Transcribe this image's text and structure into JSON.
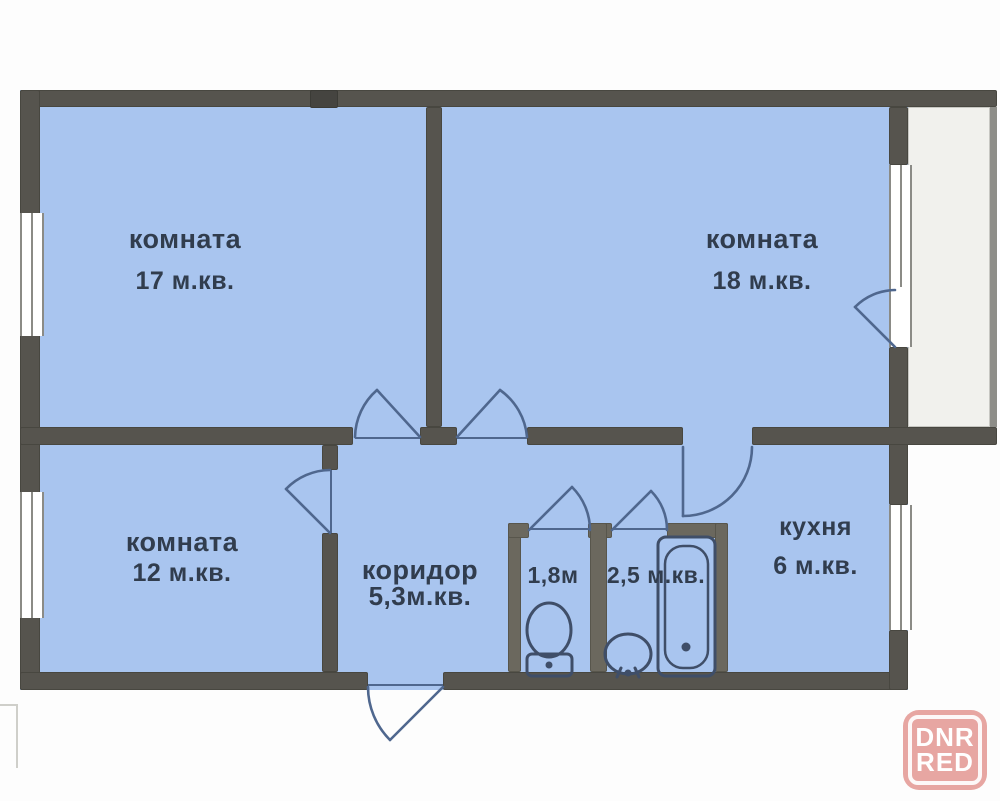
{
  "colors": {
    "wall": "#56544e",
    "wall-light": "#6b685e",
    "wall-dark": "#454440",
    "room-fill": "#a9c5ef",
    "balcony-fill": "#f1f1ed",
    "outer-balcony-wall": "#8d8d88",
    "bg": "#fdfdfd",
    "door-line": "#4f678e",
    "fixture-line": "#3f4e68",
    "window-frame": "#8b8b86",
    "text": "#313d4e",
    "watermark-bg": "#e7a6a2",
    "watermark-text": "#ffffff",
    "neighbor-line": "#cfcfca"
  },
  "rooms": {
    "room17": {
      "label": "комната",
      "area": "17 м.кв."
    },
    "room18": {
      "label": "комната",
      "area": "18 м.кв."
    },
    "room12": {
      "label": "комната",
      "area": "12 м.кв."
    },
    "corridor": {
      "label": "коридор",
      "area": "5,3м.кв."
    },
    "toilet": {
      "area": "1,8м"
    },
    "bath": {
      "area": "2,5 м.кв."
    },
    "kitchen": {
      "label": "кухня",
      "area": "6 м.кв."
    }
  },
  "watermark": {
    "line1": "DNR",
    "line2": "RED"
  },
  "elements": {
    "doors": [
      "room17-door",
      "room18-door",
      "room12-door",
      "toilet-door",
      "bath-door",
      "kitchen-door",
      "balcony-door",
      "entrance-door"
    ],
    "windows": [
      "room17-window",
      "room12-window",
      "balcony-window",
      "kitchen-window"
    ],
    "fixtures": [
      "toilet",
      "sink",
      "bathtub"
    ],
    "balcony": "yes"
  }
}
